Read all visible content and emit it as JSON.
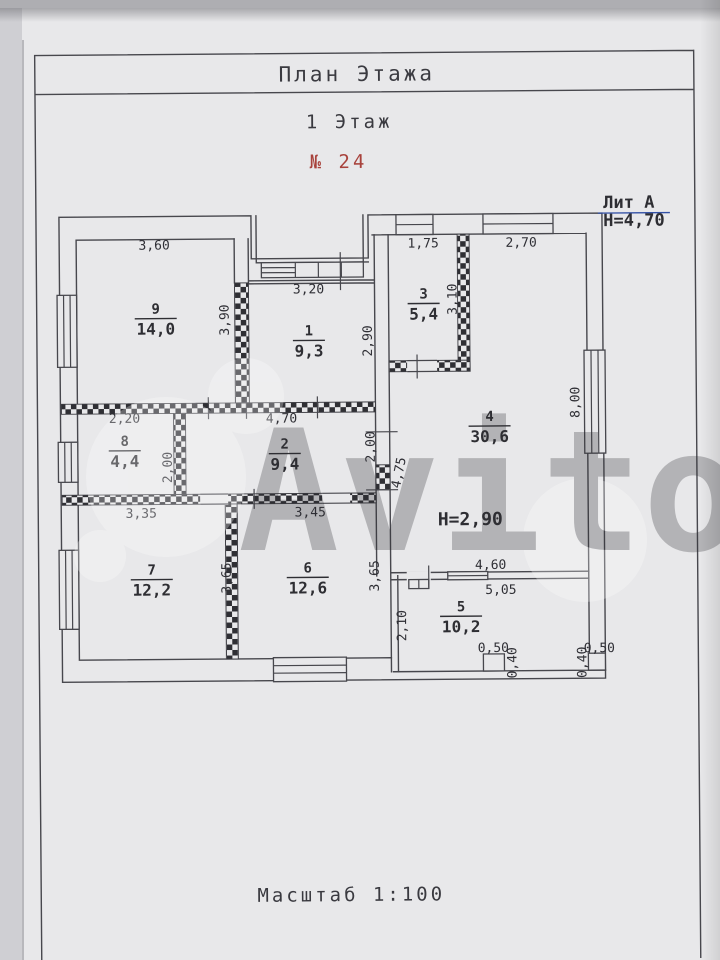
{
  "page": {
    "title": "План Этажа",
    "floor_label": "1 Этаж",
    "plan_number": "№ 24",
    "scale_label": "Масштаб 1:100",
    "watermark": "Avito"
  },
  "colors": {
    "ink": "#3a3a40",
    "blue": "#3250a5",
    "red": "#a8423c",
    "paper": "#e8e8ea"
  },
  "annotations": [
    {
      "id": "lit-a",
      "text": "Лит А",
      "x": 631,
      "y": 210,
      "color": "blue",
      "size": 17
    },
    {
      "id": "h-top",
      "text": "H=4,70",
      "x": 636,
      "y": 228,
      "color": "blue",
      "size": 17
    },
    {
      "id": "h-inner",
      "text": "H=2,90",
      "x": 470,
      "y": 526,
      "color": "blue",
      "size": 18
    }
  ],
  "rooms": [
    {
      "number": "1",
      "area": "9,3",
      "x": 310,
      "y": 330
    },
    {
      "number": "2",
      "area": "9,4",
      "x": 285,
      "y": 443
    },
    {
      "number": "3",
      "area": "5,4",
      "x": 425,
      "y": 294
    },
    {
      "number": "4",
      "area": "30,6",
      "x": 490,
      "y": 417
    },
    {
      "number": "5",
      "area": "10,2",
      "x": 460,
      "y": 607
    },
    {
      "number": "6",
      "area": "12,6",
      "x": 307,
      "y": 567
    },
    {
      "number": "7",
      "area": "12,2",
      "x": 151,
      "y": 568
    },
    {
      "number": "8",
      "area": "4,4",
      "x": 125,
      "y": 439
    },
    {
      "number": "9",
      "area": "14,0",
      "x": 157,
      "y": 307
    }
  ],
  "dimensions": [
    {
      "text": "3,60",
      "x": 156,
      "y": 244
    },
    {
      "text": "3,90",
      "x": 226,
      "y": 319,
      "rot": -90
    },
    {
      "text": "3,20",
      "x": 310,
      "y": 289
    },
    {
      "text": "2,90",
      "x": 369,
      "y": 341,
      "rot": -90
    },
    {
      "text": "1,75",
      "x": 425,
      "y": 244
    },
    {
      "text": "2,70",
      "x": 523,
      "y": 244
    },
    {
      "text": "3,10",
      "x": 454,
      "y": 300,
      "rot": -90
    },
    {
      "text": "8,00",
      "x": 576,
      "y": 404,
      "rot": -90
    },
    {
      "text": "2,20",
      "x": 125,
      "y": 417
    },
    {
      "text": "4,70",
      "x": 282,
      "y": 418
    },
    {
      "text": "2,00",
      "x": 168,
      "y": 466,
      "rot": -90
    },
    {
      "text": "2,00",
      "x": 371,
      "y": 447,
      "rot": -90
    },
    {
      "text": "4,75",
      "x": 399,
      "y": 473,
      "rot": -78
    },
    {
      "text": "3,35",
      "x": 141,
      "y": 512
    },
    {
      "text": "3,45",
      "x": 310,
      "y": 512
    },
    {
      "text": "3,65",
      "x": 226,
      "y": 577,
      "rot": -90
    },
    {
      "text": "3,65",
      "x": 374,
      "y": 576,
      "rot": -90
    },
    {
      "text": "4,60",
      "x": 490,
      "y": 566
    },
    {
      "text": "5,05",
      "x": 500,
      "y": 591
    },
    {
      "text": "2,10",
      "x": 401,
      "y": 626,
      "rot": -90
    },
    {
      "text": "0,50",
      "x": 492,
      "y": 649
    },
    {
      "text": "0,40",
      "x": 511,
      "y": 664,
      "rot": -90
    },
    {
      "text": "0,50",
      "x": 598,
      "y": 650
    },
    {
      "text": "0,40",
      "x": 581,
      "y": 664,
      "rot": -90
    }
  ]
}
